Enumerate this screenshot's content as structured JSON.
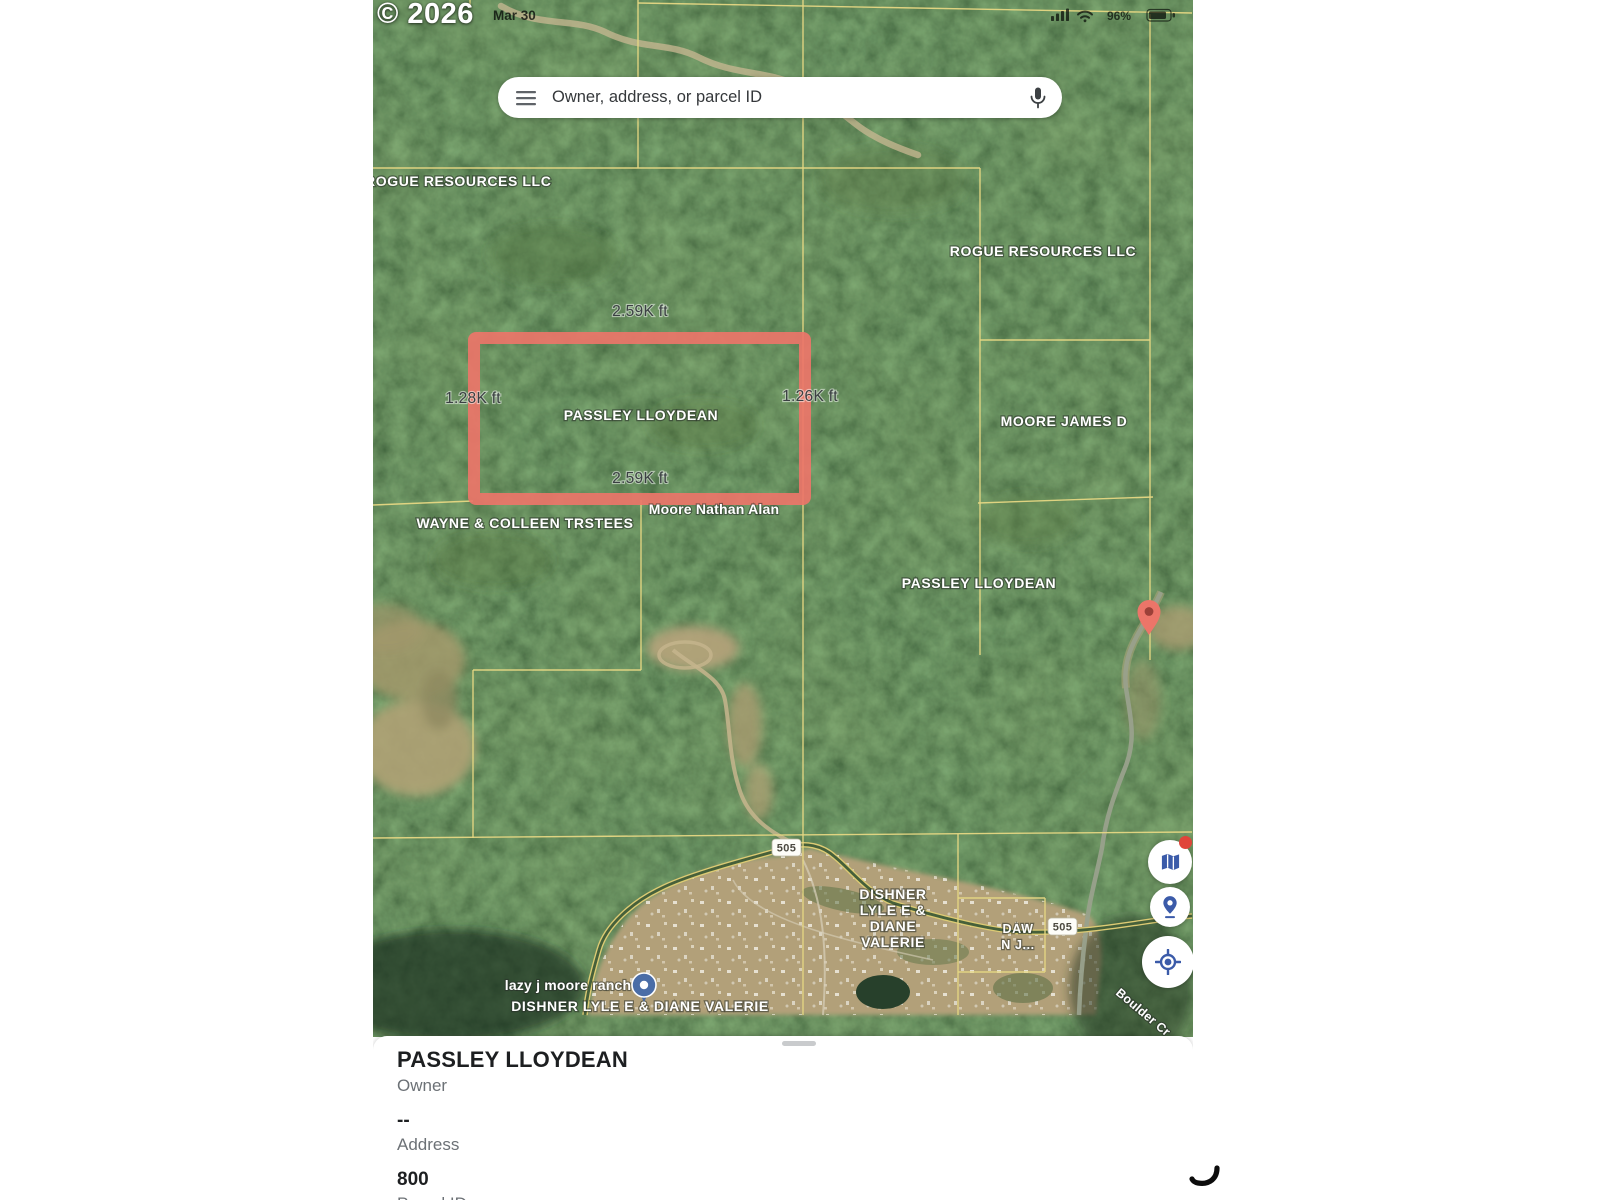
{
  "status_bar": {
    "date": "Mar 30",
    "battery_percent": "96%"
  },
  "watermark": "© 2026",
  "search": {
    "placeholder": "Owner, address, or parcel ID"
  },
  "map": {
    "labels": {
      "rogue_left": "ROGUE RESOURCES LLC",
      "rogue_right": "ROGUE RESOURCES LLC",
      "moore_james": "MOORE JAMES D",
      "passley_parcel": "PASSLEY LLOYDEAN",
      "wayne_colleen": "WAYNE & COLLEEN TRSTEES",
      "moore_nathan": "Moore Nathan Alan",
      "passley_right": "PASSLEY LLOYDEAN",
      "dishner_lines": [
        "DISHNER",
        "LYLE E &",
        "DIANE",
        "VALERIE"
      ],
      "daw_lines": [
        "DAW",
        "N J..."
      ],
      "lazy_j": "lazy j moore ranch",
      "dishner_bottom": "DISHNER LYLE E & DIANE VALERIE",
      "boulder_road": "Boulder Cr"
    },
    "measurements": {
      "top": "2.59K ft",
      "left": "1.28K ft",
      "right": "1.26K ft",
      "bottom": "2.59K ft"
    },
    "route_badge": "505",
    "colors": {
      "parcel_line": "#e6d783",
      "highlight": "#ec7569",
      "fab_icon": "#3b5ba9",
      "poi_pin": "#4a6da7",
      "notification_dot": "#e0453a"
    }
  },
  "panel": {
    "owner_value": "PASSLEY LLOYDEAN",
    "owner_label": "Owner",
    "address_value": "--",
    "address_label": "Address",
    "parcel_value": "800",
    "parcel_label": "Parcel ID"
  }
}
